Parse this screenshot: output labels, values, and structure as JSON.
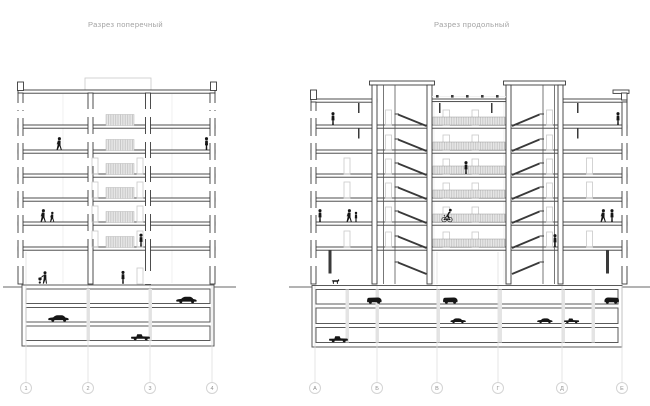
{
  "left_section": {
    "title": "Разрез поперечный",
    "axis_labels": [
      "1",
      "2",
      "3",
      "4"
    ]
  },
  "right_section": {
    "title": "Разрез продольный",
    "axis_labels": [
      "А",
      "Б",
      "В",
      "Г",
      "Д",
      "Е"
    ]
  },
  "palette": {
    "section_line": "#3a3a3a",
    "light_line": "#c9c9c9",
    "ground_line": "#9a9a9a",
    "hatch_fill": "#e6e6e6",
    "hatch_tick": "#c2c2c2",
    "figure": "#161616",
    "axis_circle": "#d4d4d4",
    "axis_text": "#8f8f8f",
    "title_text": "#a3a3a3",
    "background": "#ffffff"
  }
}
